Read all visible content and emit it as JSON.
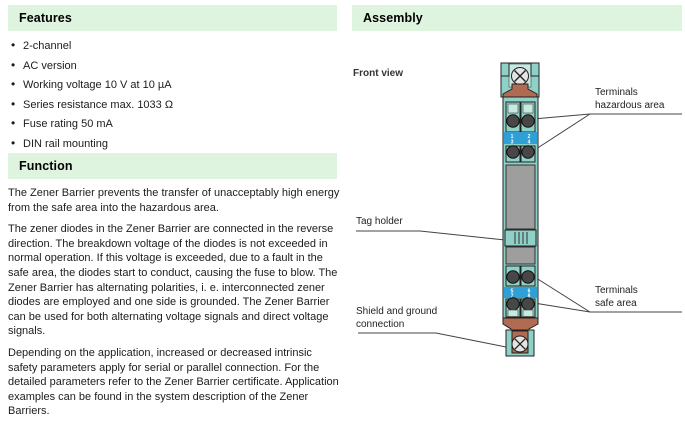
{
  "theme": {
    "header_green": "#def4de",
    "text": "#1c1c1c",
    "teal": "#8fd1c6",
    "teal_light": "#c6eae2",
    "blue": "#2f9fd6",
    "copper": "#b06b52",
    "gray": "#9e9e9e",
    "line": "#444444",
    "screw": "#e4e4e4",
    "terminal_dark": "#474747"
  },
  "features": {
    "header": "Features",
    "items": [
      "2-channel",
      "AC version",
      "Working voltage 10 V at 10 µA",
      "Series resistance max. 1033 Ω",
      "Fuse rating 50 mA",
      "DIN rail mounting"
    ]
  },
  "function_section": {
    "header": "Function",
    "paragraphs": [
      "The Zener Barrier prevents the transfer of unacceptably high energy from the safe area into the hazardous area.",
      "The zener diodes in the Zener Barrier are connected in the reverse direction. The breakdown voltage of the diodes is not exceeded in normal operation. If this voltage is exceeded, due to a fault in the safe area, the diodes start to conduct, causing the fuse to blow. The Zener Barrier has alternating polarities, i. e. interconnected zener diodes are employed and one side is grounded. The Zener Barrier can be used for both alternating voltage signals and direct voltage signals.",
      "Depending on the application, increased or decreased intrinsic safety parameters apply for serial or parallel connection. For the detailed parameters refer to the Zener Barrier certificate. Application examples can be found in the system description of the Zener Barriers."
    ]
  },
  "assembly": {
    "header": "Assembly",
    "front_view_label": "Front view",
    "callouts": {
      "terminals_hazardous": "Terminals\nhazardous area",
      "tag_holder": "Tag holder",
      "terminals_safe": "Terminals\nsafe area",
      "shield_ground": "Shield and ground\nconnection"
    },
    "terminal_numbers": {
      "hazardous": [
        "1",
        "3",
        "2",
        "4"
      ],
      "safe": [
        "5",
        "7",
        "6",
        "8"
      ]
    }
  }
}
